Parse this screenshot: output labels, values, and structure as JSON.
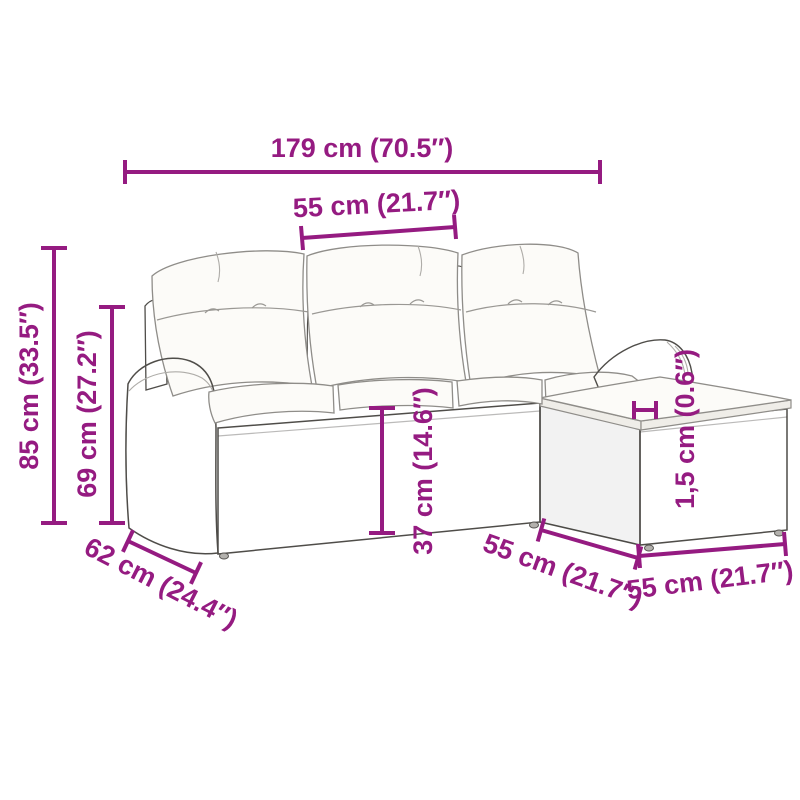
{
  "colors": {
    "dimension_accent": "#951b81",
    "wicker_gray": "#cbc9c4",
    "weave_line_gray": "#8b8984",
    "cushion_white": "#fcfbf8",
    "outline_gray": "#4f4d49",
    "background": "#ffffff"
  },
  "dimensions": {
    "overall_width": {
      "label": "179 cm (70.5″)"
    },
    "seat_width": {
      "label": "55 cm (21.7″)"
    },
    "overall_height": {
      "label": "85 cm (33.5″)"
    },
    "armrest_height": {
      "label": "69 cm (27.2″)"
    },
    "seat_height": {
      "label": "37 cm (14.6″)"
    },
    "cushion_thickness": {
      "label": "1,5 cm (0.6″)"
    },
    "seat_depth": {
      "label": "62 cm (24.4″)"
    },
    "footstool_depth": {
      "label": "55 cm (21.7″)"
    },
    "footstool_width": {
      "label": "55 cm (21.7″)"
    }
  }
}
